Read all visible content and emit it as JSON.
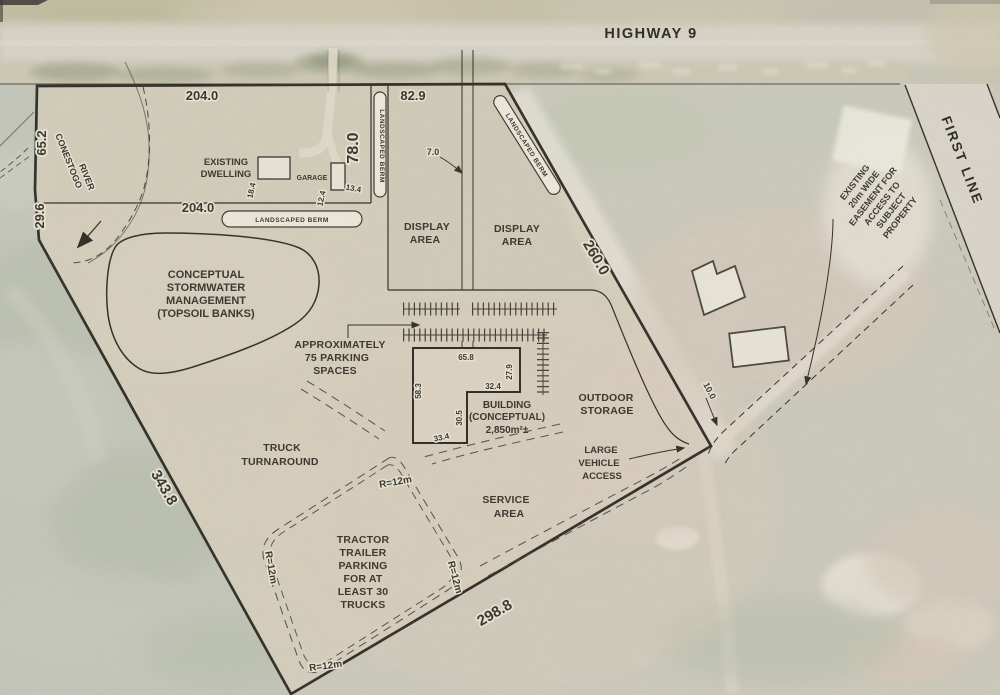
{
  "roads": {
    "highway": "HIGHWAY 9",
    "first_line": "FIRST LINE"
  },
  "river": [
    "CONESTOGO",
    "RIVER"
  ],
  "berm_label": "LANDSCAPED BERM",
  "labels": {
    "existing_dwelling": [
      "EXISTING",
      "DWELLING"
    ],
    "garage": "GARAGE",
    "stormwater": [
      "CONCEPTUAL",
      "STORMWATER",
      "MANAGEMENT",
      "(TOPSOIL BANKS)"
    ],
    "display_left": [
      "DISPLAY",
      "AREA"
    ],
    "display_right": [
      "DISPLAY",
      "AREA"
    ],
    "parking": [
      "APPROXIMATELY",
      "75 PARKING",
      "SPACES"
    ],
    "building": [
      "BUILDING",
      "(CONCEPTUAL)",
      "2,850m²±"
    ],
    "outdoor_storage": [
      "OUTDOOR",
      "STORAGE"
    ],
    "large_vehicle_access": [
      "LARGE",
      "VEHICLE",
      "ACCESS"
    ],
    "truck_turnaround": [
      "TRUCK",
      "TURNAROUND"
    ],
    "service_area": [
      "SERVICE",
      "AREA"
    ],
    "tractor_trailer": [
      "TRACTOR",
      "TRAILER",
      "PARKING",
      "FOR AT",
      "LEAST 30",
      "TRUCKS"
    ],
    "easement": [
      "EXISTING",
      "20m WIDE",
      "EASEMENT FOR",
      "ACCESS TO",
      "SUBJECT",
      "PROPERTY"
    ]
  },
  "dims": {
    "top_west": "204.0",
    "top_east": "82.9",
    "west_upper": "65.2",
    "west_lower": "29.6",
    "dwelling_south": "204.0",
    "dwelling_east": "78.0",
    "northeast": "260.0",
    "southwest": "343.8",
    "south": "298.8",
    "road_width": "7.0",
    "easement_width": "10.0",
    "dwelling": "18.4",
    "garage_a": "12.4",
    "garage_b": "13.4",
    "bldg_top": "65.8",
    "bldg_right": "27.9",
    "bldg_step": "32.4",
    "bldg_left": "58.3",
    "bldg_notch": "30.5",
    "bldg_bottom": "33.4",
    "r_top": "R=12m",
    "r_left": "R=12m",
    "r_right": "R=12m",
    "r_bottom": "R=12m"
  },
  "colors": {
    "paper": "#d6cfbc",
    "ink": "#2e2b25",
    "aerial": "#c8c6b6"
  }
}
